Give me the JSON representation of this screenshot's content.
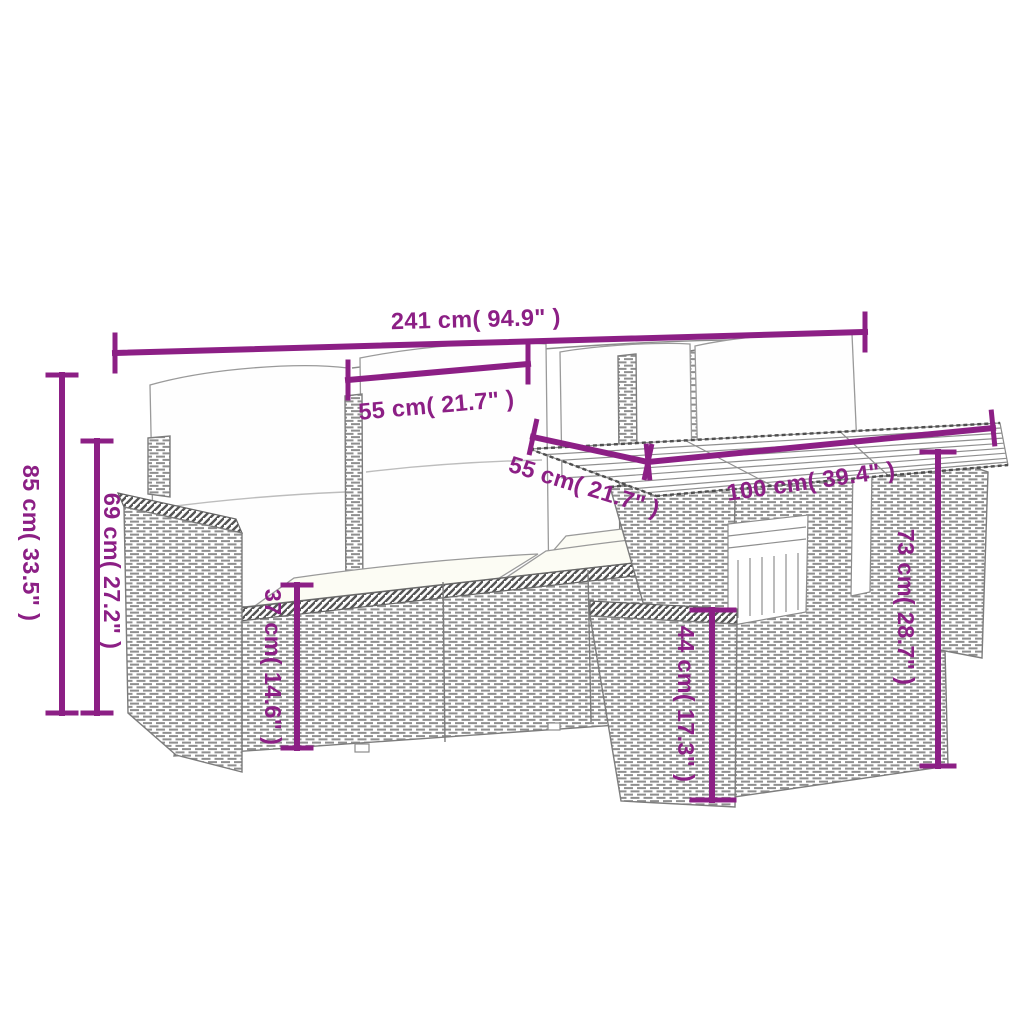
{
  "diagram": {
    "description": "Dimension line-art diagram of a poly rattan garden lounge set: sofa with cushions, left armrest, slat-top table and stool",
    "colors": {
      "accent": "#8C1F85",
      "line_art": "#8C8C8C",
      "background": "#FFFFFF"
    },
    "dimensions": {
      "overall_width": "241 cm( 94.9\" )",
      "seat_width": "55 cm( 21.7\" )",
      "overall_height": "85 cm( 33.5\" )",
      "backrest_height": "69 cm( 27.2\" )",
      "seat_height": "37 cm( 14.6\" )",
      "table_depth": "55 cm( 21.7\" )",
      "table_width": "100 cm( 39.4\" )",
      "table_height": "73 cm( 28.7\" )",
      "stool_height": "44 cm( 17.3\" )"
    }
  }
}
